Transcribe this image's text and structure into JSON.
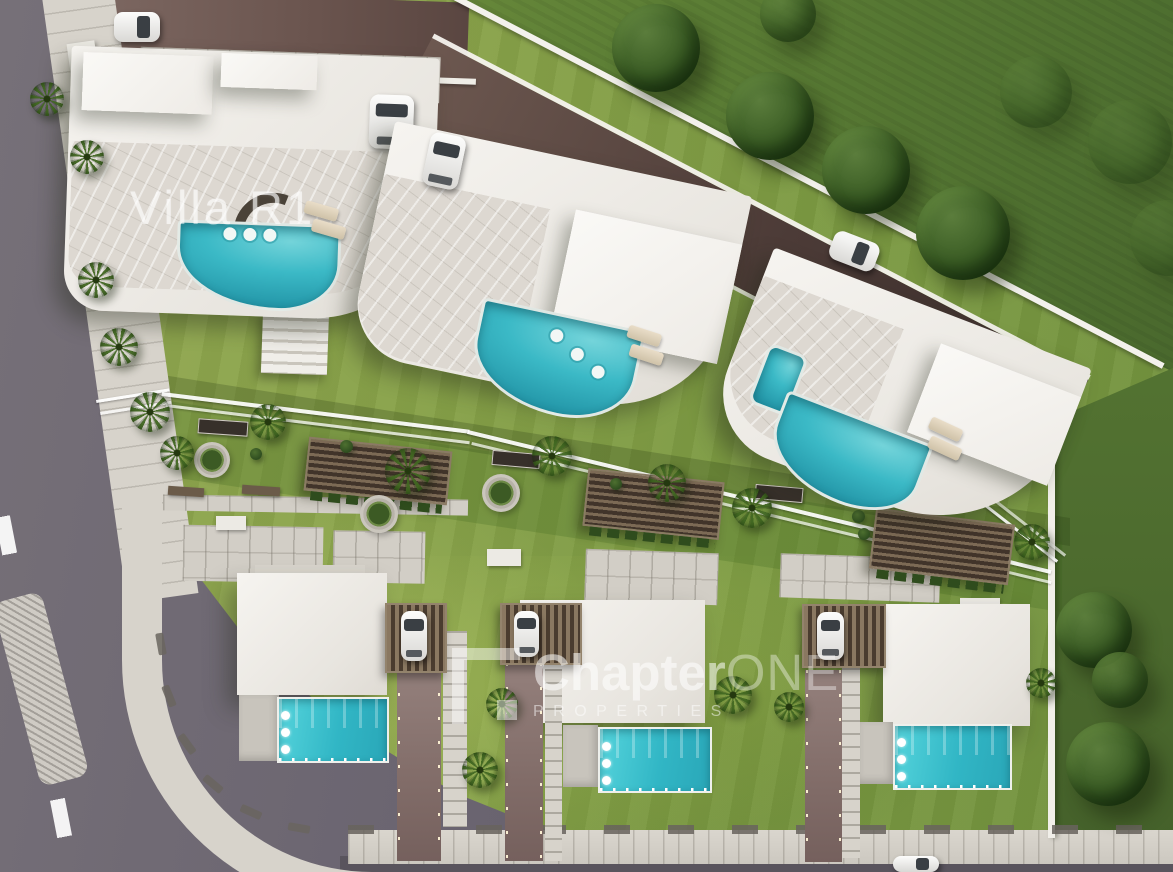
{
  "labels": {
    "villa_r1": "Villa R1"
  },
  "watermark": {
    "logo": "chapter-one-logo",
    "brand_primary": "Chapter",
    "brand_secondary": "ONE",
    "tagline": "PROPERTIES"
  },
  "colors": {
    "grass": "#87a24a",
    "grass_dark": "#587a33",
    "road_asphalt": "#6e6871",
    "road_access_dark": "#44332f",
    "road_access_light": "#7b665f",
    "driveway": "#8a7370",
    "sidewalk": "#d7d3cb",
    "roof": "#eeece7",
    "terrace_marble": "#dcd7d0",
    "patio": "#c7c3bb",
    "pergola_wood": "#57452f",
    "pool": "#3bb9c6",
    "pool_bright": "#45cdd6",
    "tree": "#35551f",
    "palm": "#48702c",
    "lane_marking": "#ffffff",
    "wall": "#f2f0ea",
    "watermark": "#ffffff"
  }
}
